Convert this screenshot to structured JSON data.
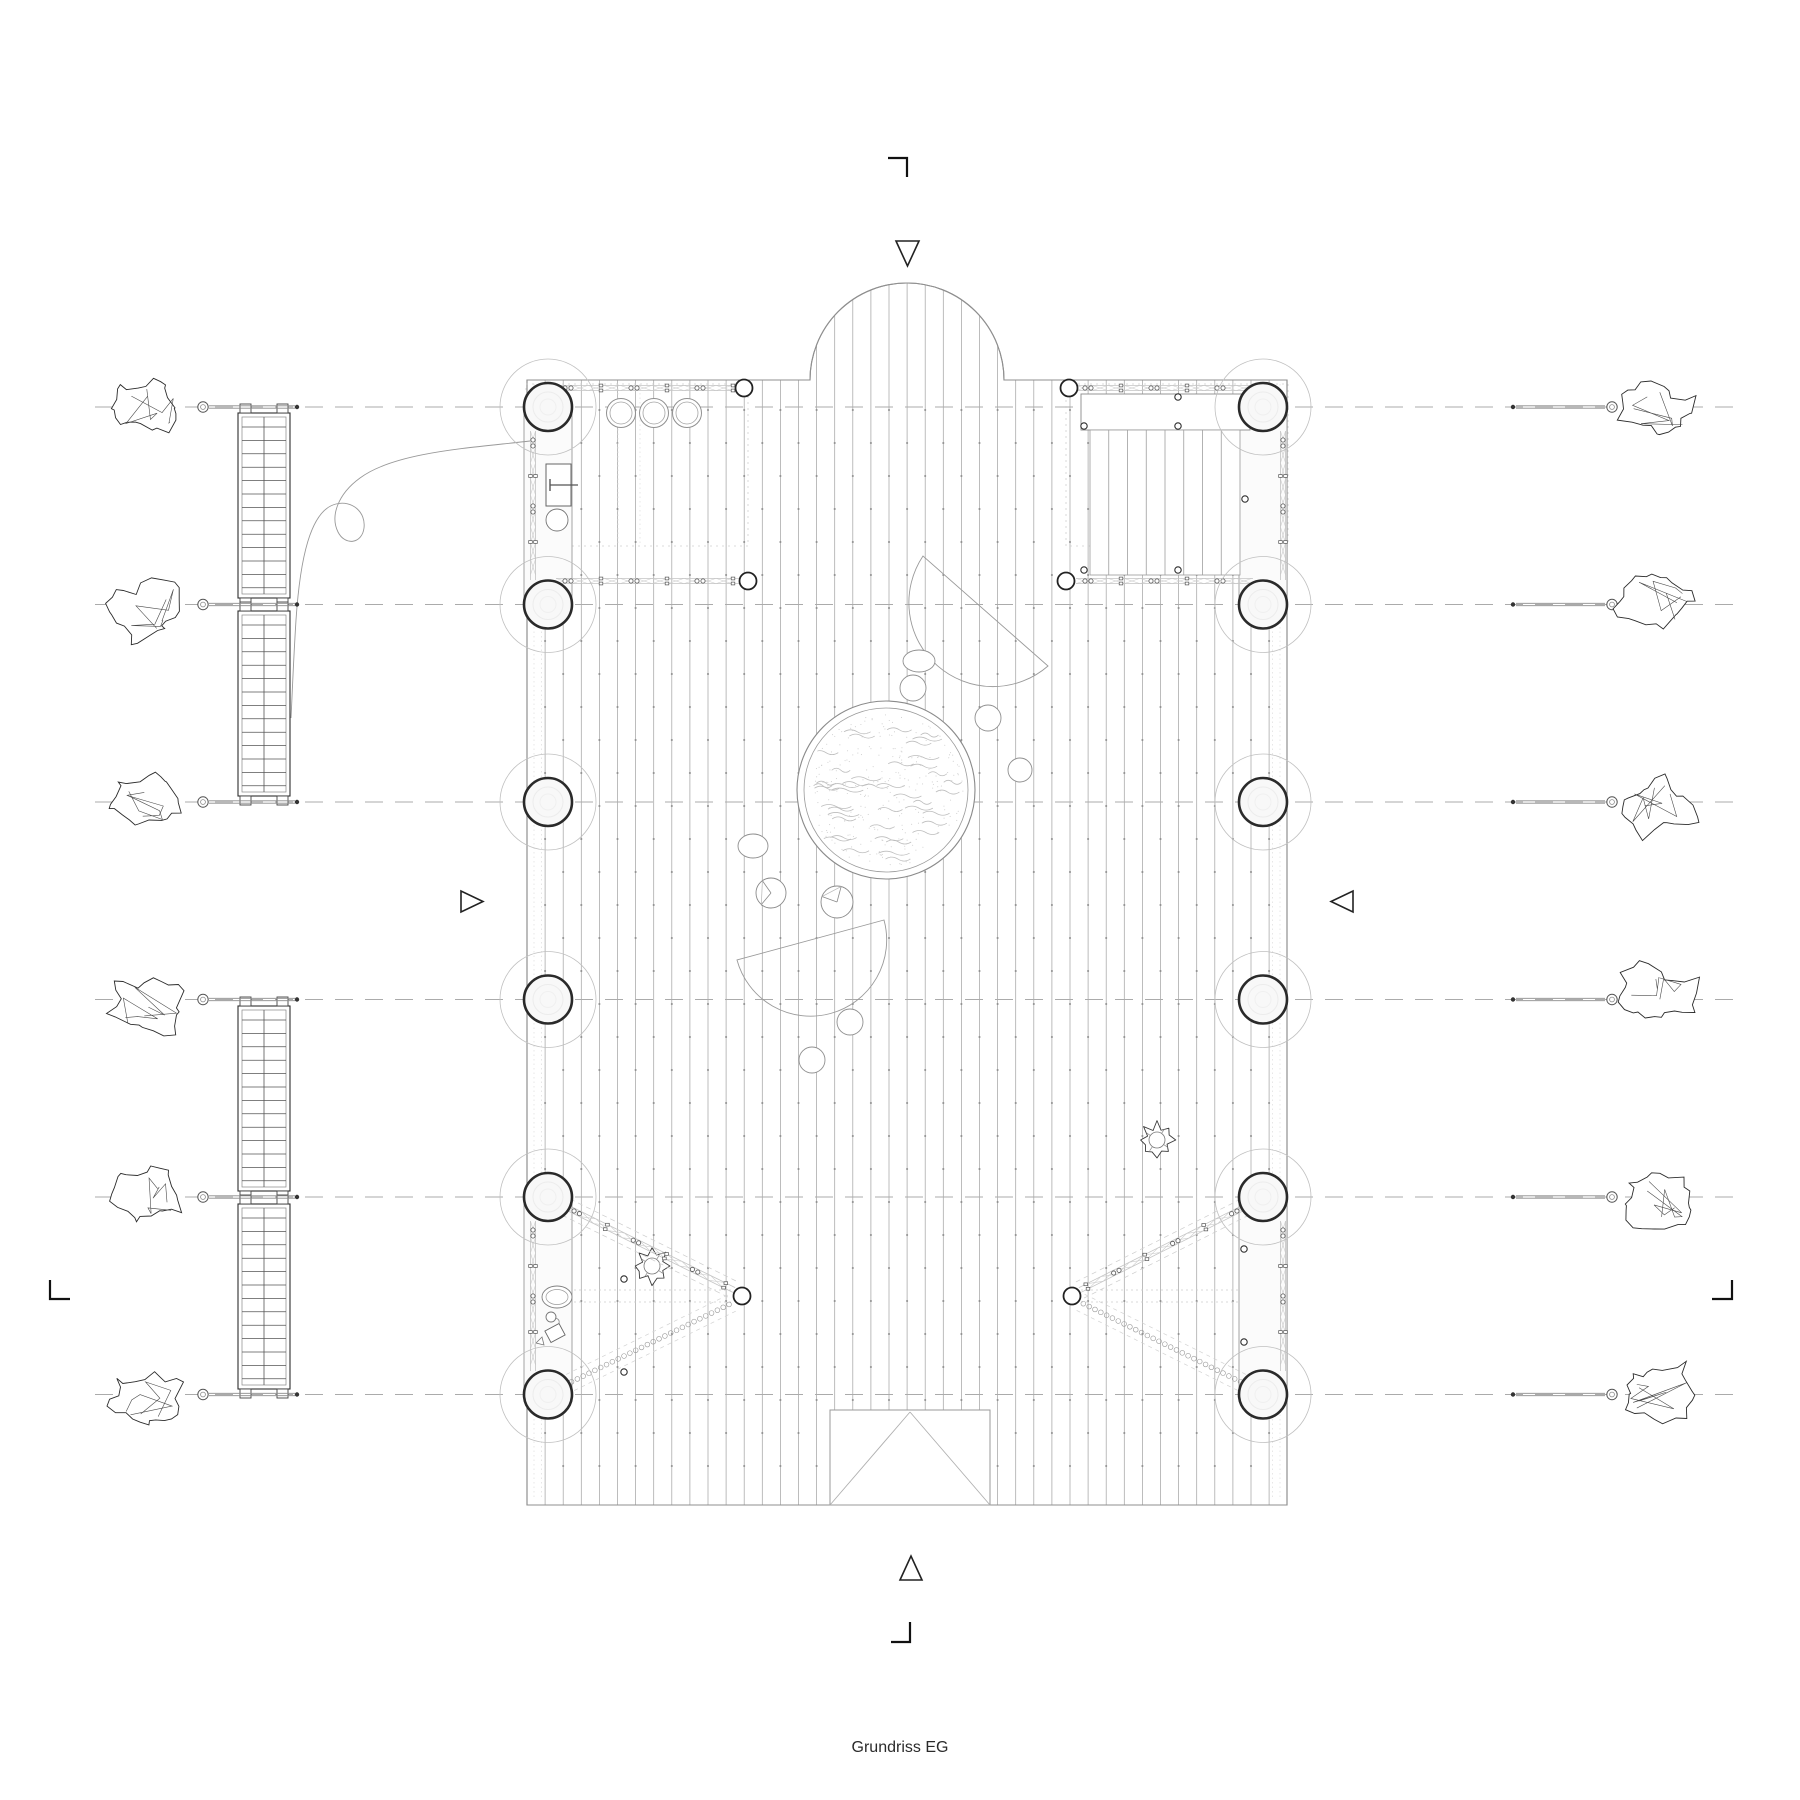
{
  "title": "Grundriss EG",
  "drawing": {
    "bg": "#ffffff",
    "ink": "#1a1a1a",
    "mid": "#8a8a8a",
    "light": "#c4c4c4",
    "grid": {
      "rows": [
        407,
        604.5,
        802,
        999.5,
        1197,
        1394.5
      ],
      "x0": 95,
      "x1": 1740
    },
    "deck": {
      "x0": 527,
      "y0": 380,
      "x1": 1287,
      "y1": 1505,
      "plank_spacing": 18.1,
      "joint_spacing": 66,
      "apse": {
        "cx": 907,
        "r": 97
      },
      "entrance": {
        "x0": 830,
        "x1": 990,
        "y0": 1410,
        "apex_x": 910,
        "apex_y": 1412
      }
    },
    "columns": {
      "left_x": 548,
      "right_x": 1263,
      "r": 24,
      "halo_r": 48,
      "paired_rows": [
        [
          0,
          1
        ],
        [
          4,
          5
        ]
      ]
    },
    "pool": {
      "cx": 886,
      "cy": 790,
      "r_outer": 89,
      "r_inner": 82
    },
    "half_discs": [
      {
        "x1": 923,
        "y1": 556,
        "x2": 1048,
        "y2": 666,
        "r": 84,
        "sweep": 0
      },
      {
        "x1": 884,
        "y1": 920,
        "x2": 737,
        "y2": 960,
        "r": 76,
        "sweep": 1
      }
    ],
    "small_circles": [
      [
        913,
        688,
        13
      ],
      [
        988,
        718,
        13
      ],
      [
        1020,
        770,
        12
      ],
      [
        850,
        1022,
        13
      ],
      [
        812,
        1060,
        13
      ]
    ],
    "ellipses": [
      [
        919,
        661,
        16,
        11
      ],
      [
        753,
        846,
        15,
        12
      ]
    ],
    "pie_circles": [
      [
        771,
        893,
        15,
        130,
        235
      ],
      [
        837,
        902,
        16,
        200,
        285
      ]
    ],
    "trees": [
      [
        652,
        1266
      ],
      [
        1157,
        1140
      ]
    ],
    "stools": [
      [
        621,
        413
      ],
      [
        654,
        413
      ],
      [
        687,
        413
      ]
    ],
    "cabinet": {
      "x0": 546,
      "y0": 464,
      "x1": 571,
      "y1": 506,
      "circle": [
        557,
        520,
        11
      ]
    },
    "beam_items": {
      "ellipse": [
        557,
        1297,
        15,
        11
      ],
      "cup": [
        551,
        1317,
        5
      ],
      "box": [
        555,
        1333,
        16,
        13,
        -28
      ]
    },
    "bolts": [
      [
        1178,
        397
      ],
      [
        1084,
        426
      ],
      [
        1178,
        426
      ],
      [
        1084,
        570
      ],
      [
        1178,
        570
      ],
      [
        1245,
        499
      ],
      [
        624,
        1279
      ],
      [
        624,
        1372
      ],
      [
        1244,
        1249
      ],
      [
        1244,
        1342
      ]
    ],
    "platform": {
      "band": [
        1081,
        394,
        1250,
        430
      ],
      "planks": [
        1090,
        430,
        1240,
        575
      ],
      "n_planks": 7
    },
    "chains": {
      "horizontal": [
        [
          556,
          388,
          740,
          388
        ],
        [
          556,
          581,
          740,
          581
        ],
        [
          1076,
          388,
          1253,
          388
        ],
        [
          1076,
          581,
          1253,
          581
        ]
      ],
      "vertical": [
        [
          533,
          431,
          533,
          580
        ],
        [
          533,
          1221,
          533,
          1371
        ],
        [
          1283,
          431,
          1283,
          580
        ],
        [
          1283,
          1221,
          1283,
          1371
        ]
      ],
      "diagonal": [
        [
          566,
          1207,
          734,
          1290
        ],
        [
          1245,
          1207,
          1080,
          1290
        ]
      ],
      "beads": [
        [
          563,
          1386,
          734,
          1302
        ],
        [
          1249,
          1386,
          1080,
          1302
        ]
      ],
      "nodes": [
        [
          744,
          388
        ],
        [
          748,
          581
        ],
        [
          1069,
          388
        ],
        [
          1066,
          581
        ],
        [
          742,
          1296
        ],
        [
          1072,
          1296
        ]
      ]
    },
    "guides": {
      "dotted_rects": [
        [
          526,
          384,
          748,
          546
        ],
        [
          1066,
          384,
          1288,
          546
        ]
      ],
      "dotted_verticals": [
        [
          534,
          384,
          1500
        ],
        [
          541.5,
          384,
          1500
        ],
        [
          1272.5,
          384,
          1500
        ],
        [
          1280,
          384,
          1500
        ],
        [
          618,
          384,
          546
        ],
        [
          640,
          384,
          546
        ],
        [
          1174,
          384,
          546
        ],
        [
          1196,
          384,
          546
        ]
      ],
      "apex_dotted": [
        [
          574,
          1290,
          733,
          1290
        ],
        [
          574,
          1302,
          733,
          1302
        ],
        [
          1081,
          1290,
          1240,
          1290
        ],
        [
          1081,
          1302,
          1240,
          1302
        ]
      ]
    },
    "ladder": {
      "x0": 238,
      "x1": 290,
      "segments": [
        [
          413,
          598
        ],
        [
          611,
          796
        ],
        [
          1006,
          1191
        ],
        [
          1204,
          1389
        ]
      ]
    },
    "rope": "M 530 441 C 470 448 395 452 360 478 C 338 494 330 516 338 532 C 345 546 362 544 364 528 C 366 512 352 500 336 504 C 310 510 300 560 296 620 C 293 668 292 700 291 718",
    "anchors": {
      "left": {
        "rock_x": 148,
        "shackle_x": 203,
        "line_x0": 209,
        "line_x1": 295,
        "dot_x": 297,
        "rock_w": 78,
        "rock_h": 60
      },
      "right": {
        "dot_x": 1513,
        "line_x0": 1516,
        "line_x1": 1605,
        "shackle_x": 1612,
        "rock_x": 1658,
        "rock_w": 82,
        "rock_h": 58
      }
    },
    "markers": {
      "tri_down": [
        [
          896,
          241
        ],
        [
          919,
          241
        ],
        [
          907.5,
          266
        ]
      ],
      "tri_up": [
        [
          900,
          1580
        ],
        [
          922,
          1580
        ],
        [
          911,
          1556
        ]
      ],
      "tri_right": [
        [
          461,
          891
        ],
        [
          461,
          912
        ],
        [
          483,
          901.5
        ]
      ],
      "tri_left": [
        [
          1353,
          891
        ],
        [
          1353,
          912
        ],
        [
          1331,
          901.5
        ]
      ],
      "crop_top": "M888 158 H907 V177",
      "crop_bottom": "M910 1622 V1642 H891",
      "crop_left": "M50 1280 V1299 H70",
      "crop_right": "M1732 1280 V1299 H1712"
    }
  }
}
